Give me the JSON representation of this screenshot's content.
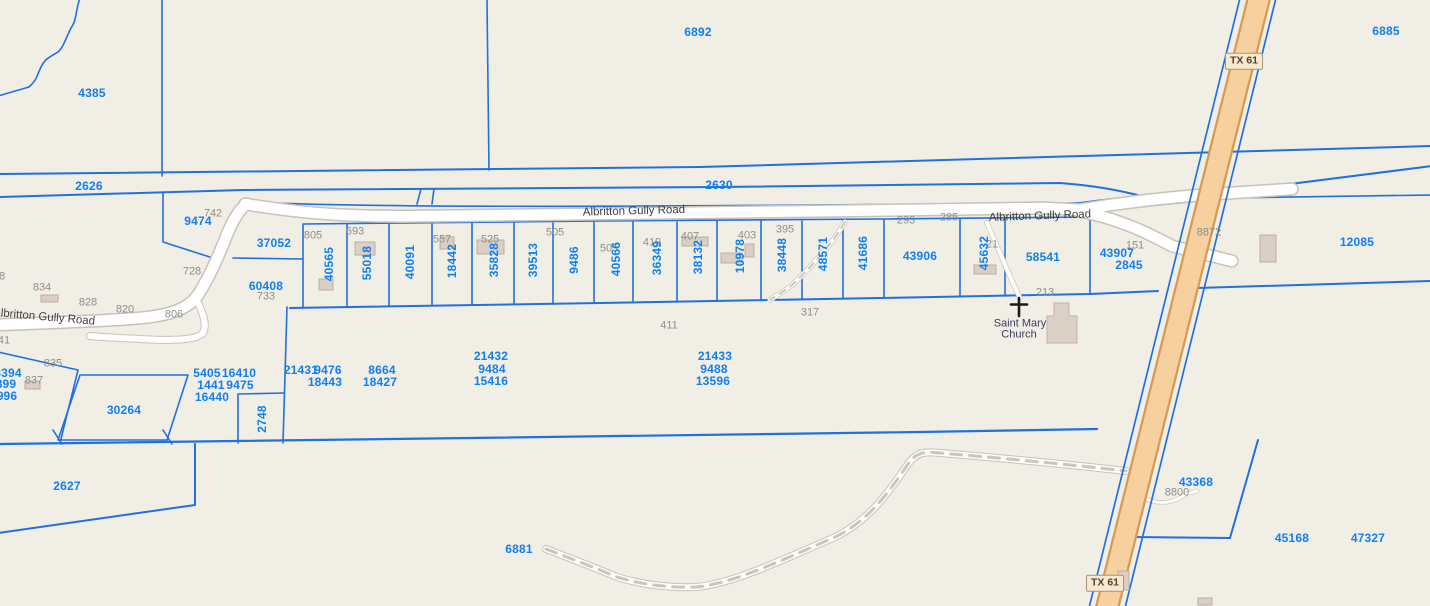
{
  "map": {
    "title": "parcel-map-view",
    "colors": {
      "background": "#f1eee6",
      "parcel_line": "#2170e0",
      "parcel_label": "#0f80f0",
      "address_label": "#8e8e8a",
      "road_fill": "#ffffff",
      "road_casing": "#c8c2b8",
      "highway_fill": "#f7d0a0",
      "highway_casing": "#d69a52",
      "shield_fill": "#f9e8cd",
      "building_fill": "#dacfc5"
    },
    "route_shields": [
      {
        "label": "TX 61",
        "x": 1244,
        "y": 61
      },
      {
        "label": "TX 61",
        "x": 1105,
        "y": 583
      }
    ],
    "road_labels": [
      {
        "text": "Albritton Gully Road",
        "x": 44,
        "y": 318,
        "rot": 5
      },
      {
        "text": "Albritton Gully Road",
        "x": 634,
        "y": 212,
        "rot": -1.5
      },
      {
        "text": "Albritton Gully Road",
        "x": 1040,
        "y": 217,
        "rot": -2
      }
    ],
    "church_label": {
      "line1": "Saint Mary",
      "line2": "Church",
      "x": 1020,
      "y1": 324,
      "y2": 335
    },
    "parcel_labels": [
      {
        "text": "4385",
        "x": 92,
        "y": 93
      },
      {
        "text": "6892",
        "x": 698,
        "y": 32
      },
      {
        "text": "6885",
        "x": 1386,
        "y": 31
      },
      {
        "text": "2626",
        "x": 89,
        "y": 186
      },
      {
        "text": "2630",
        "x": 719,
        "y": 185
      },
      {
        "text": "9474",
        "x": 198,
        "y": 221
      },
      {
        "text": "37052",
        "x": 274,
        "y": 243
      },
      {
        "text": "60408",
        "x": 266,
        "y": 286
      },
      {
        "text": "40565",
        "x": 329,
        "y": 264,
        "vertical": true
      },
      {
        "text": "55018",
        "x": 367,
        "y": 263,
        "vertical": true
      },
      {
        "text": "40091",
        "x": 410,
        "y": 262,
        "vertical": true
      },
      {
        "text": "18442",
        "x": 452,
        "y": 261,
        "vertical": true
      },
      {
        "text": "35828",
        "x": 494,
        "y": 260,
        "vertical": true
      },
      {
        "text": "39513",
        "x": 533,
        "y": 260,
        "vertical": true
      },
      {
        "text": "9486",
        "x": 574,
        "y": 260,
        "vertical": true
      },
      {
        "text": "40566",
        "x": 616,
        "y": 259,
        "vertical": true
      },
      {
        "text": "36349",
        "x": 657,
        "y": 258,
        "vertical": true
      },
      {
        "text": "38132",
        "x": 698,
        "y": 257,
        "vertical": true
      },
      {
        "text": "10978",
        "x": 740,
        "y": 256,
        "vertical": true
      },
      {
        "text": "38448",
        "x": 782,
        "y": 255,
        "vertical": true
      },
      {
        "text": "48571",
        "x": 823,
        "y": 254,
        "vertical": true
      },
      {
        "text": "41686",
        "x": 863,
        "y": 253,
        "vertical": true
      },
      {
        "text": "43906",
        "x": 920,
        "y": 256
      },
      {
        "text": "45632",
        "x": 984,
        "y": 253,
        "vertical": true
      },
      {
        "text": "58541",
        "x": 1043,
        "y": 257
      },
      {
        "text": "43907",
        "x": 1117,
        "y": 253
      },
      {
        "text": "2845",
        "x": 1129,
        "y": 265
      },
      {
        "text": "12085",
        "x": 1357,
        "y": 242
      },
      {
        "text": "3394",
        "x": 8,
        "y": 373
      },
      {
        "text": "899",
        "x": 6,
        "y": 384
      },
      {
        "text": "996",
        "x": 7,
        "y": 396
      },
      {
        "text": "30264",
        "x": 124,
        "y": 410
      },
      {
        "text": "5405",
        "x": 207,
        "y": 373
      },
      {
        "text": "16410",
        "x": 239,
        "y": 373
      },
      {
        "text": "1441",
        "x": 211,
        "y": 385
      },
      {
        "text": "9475",
        "x": 240,
        "y": 385
      },
      {
        "text": "16440",
        "x": 212,
        "y": 397
      },
      {
        "text": "21431",
        "x": 301,
        "y": 370
      },
      {
        "text": "9476",
        "x": 328,
        "y": 370
      },
      {
        "text": "18443",
        "x": 325,
        "y": 382
      },
      {
        "text": "8664",
        "x": 382,
        "y": 370
      },
      {
        "text": "18427",
        "x": 380,
        "y": 382
      },
      {
        "text": "2748",
        "x": 262,
        "y": 419,
        "vertical": true
      },
      {
        "text": "21432",
        "x": 491,
        "y": 356
      },
      {
        "text": "9484",
        "x": 492,
        "y": 369
      },
      {
        "text": "15416",
        "x": 491,
        "y": 381
      },
      {
        "text": "21433",
        "x": 715,
        "y": 356
      },
      {
        "text": "9488",
        "x": 714,
        "y": 369
      },
      {
        "text": "13596",
        "x": 713,
        "y": 381
      },
      {
        "text": "2627",
        "x": 67,
        "y": 486
      },
      {
        "text": "6881",
        "x": 519,
        "y": 549
      },
      {
        "text": "43368",
        "x": 1196,
        "y": 482
      },
      {
        "text": "45168",
        "x": 1292,
        "y": 538
      },
      {
        "text": "47327",
        "x": 1368,
        "y": 538
      }
    ],
    "address_labels": [
      {
        "text": "742",
        "x": 213,
        "y": 214
      },
      {
        "text": "728",
        "x": 192,
        "y": 272
      },
      {
        "text": "834",
        "x": 42,
        "y": 288
      },
      {
        "text": "828",
        "x": 88,
        "y": 303
      },
      {
        "text": "820",
        "x": 125,
        "y": 310
      },
      {
        "text": "806",
        "x": 174,
        "y": 315
      },
      {
        "text": "8",
        "x": 2,
        "y": 277
      },
      {
        "text": "41",
        "x": 4,
        "y": 341
      },
      {
        "text": "835",
        "x": 53,
        "y": 364
      },
      {
        "text": "837",
        "x": 34,
        "y": 381
      },
      {
        "text": "733",
        "x": 266,
        "y": 297
      },
      {
        "text": "805",
        "x": 313,
        "y": 236
      },
      {
        "text": "693",
        "x": 355,
        "y": 232
      },
      {
        "text": "557",
        "x": 442,
        "y": 240
      },
      {
        "text": "525",
        "x": 490,
        "y": 240
      },
      {
        "text": "505",
        "x": 555,
        "y": 233
      },
      {
        "text": "505",
        "x": 609,
        "y": 249
      },
      {
        "text": "419",
        "x": 652,
        "y": 243
      },
      {
        "text": "407",
        "x": 690,
        "y": 237
      },
      {
        "text": "403",
        "x": 747,
        "y": 236
      },
      {
        "text": "395",
        "x": 785,
        "y": 230
      },
      {
        "text": "293",
        "x": 906,
        "y": 221
      },
      {
        "text": "285",
        "x": 949,
        "y": 218
      },
      {
        "text": "21",
        "x": 992,
        "y": 245
      },
      {
        "text": "151",
        "x": 1135,
        "y": 246
      },
      {
        "text": "213",
        "x": 1045,
        "y": 293
      },
      {
        "text": "317",
        "x": 810,
        "y": 313
      },
      {
        "text": "411",
        "x": 669,
        "y": 326
      },
      {
        "text": "8872",
        "x": 1209,
        "y": 233
      },
      {
        "text": "8800",
        "x": 1177,
        "y": 493
      }
    ]
  }
}
